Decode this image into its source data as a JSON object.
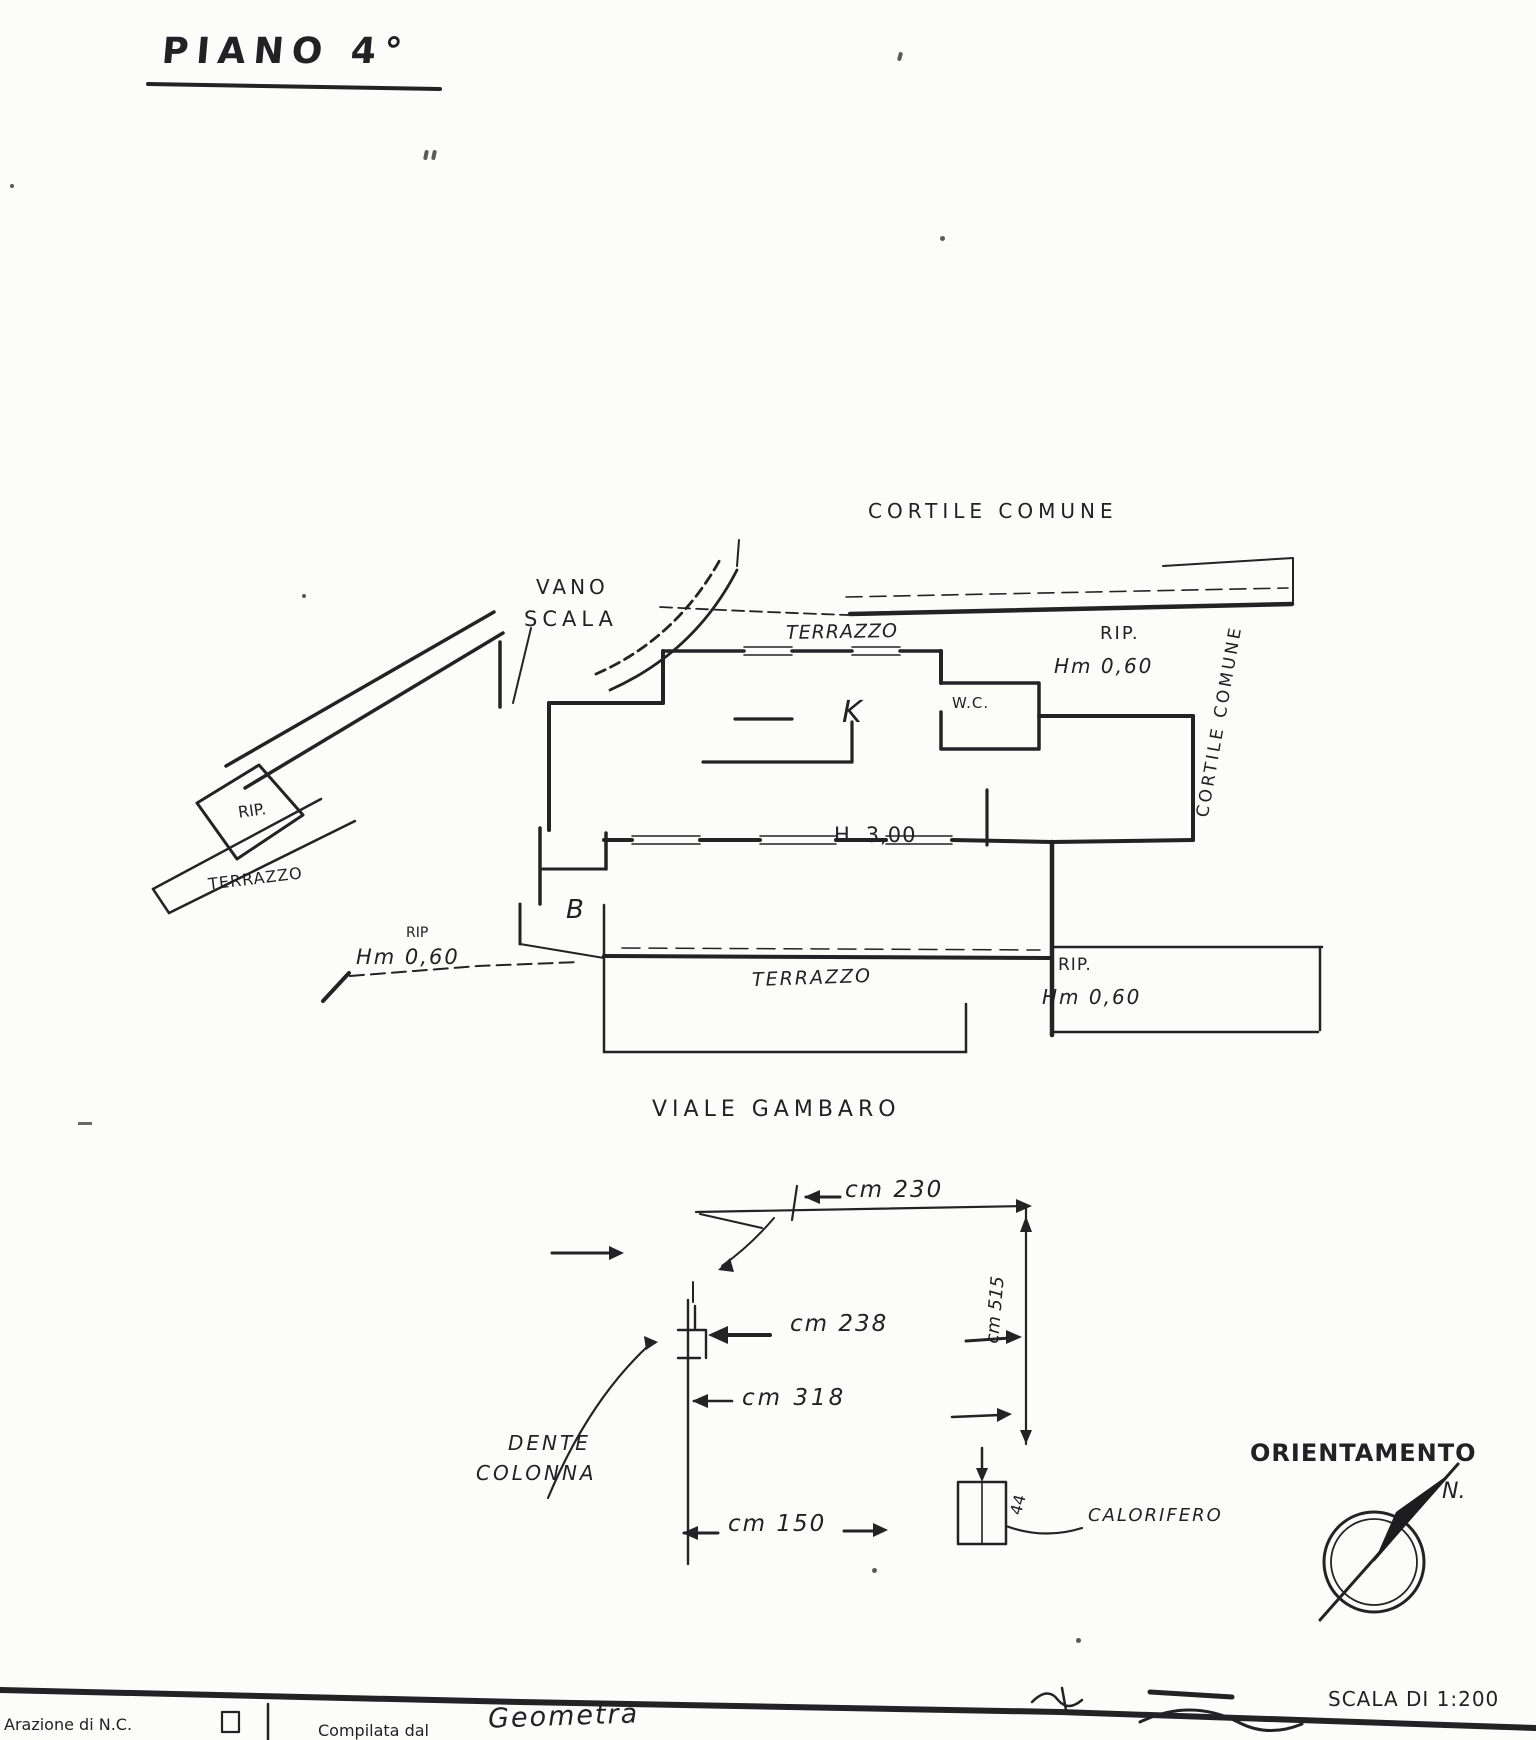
{
  "title": "PIANO 4°",
  "plan": {
    "courtyard_top": "CORTILE COMUNE",
    "courtyard_right": "CORTILE COMUNE",
    "vano_scala_line1": "VANO",
    "vano_scala_line2": "SCALA",
    "terrazzo_top": "TERRAZZO",
    "rip_top_right": "RIP.",
    "hm_top_right": "Hm 0,60",
    "wc": "W.C.",
    "kitchen": "K",
    "height_note": "H. 3,00",
    "bath": "B",
    "rip_left": "RIP.",
    "terrazzo_left": "TERRAZZO",
    "rip_mid": "RIP",
    "hm_left": "Hm 0,60",
    "terrazzo_bottom": "TERRAZZO",
    "rip_bottom_right": "RIP.",
    "hm_bottom_right": "Hm 0,60",
    "street": "VIALE GAMBARO"
  },
  "detail": {
    "dim_top": "cm 230",
    "dim_column": "cm 238",
    "dim_mid": "cm 318",
    "dim_bottom": "cm 150",
    "dim_right_vertical": "cm 515",
    "dim_radiator": "44",
    "callout_line1": "DENTE",
    "callout_line2": "COLONNA",
    "radiator_label": "CALORIFERO"
  },
  "compass": {
    "label": "ORIENTAMENTO",
    "north": "N."
  },
  "scale_note": "SCALA DI 1:200",
  "form": {
    "field1": "Arazione di N.C.",
    "field2": "Compilata dal",
    "field2_value": "Geometra"
  }
}
